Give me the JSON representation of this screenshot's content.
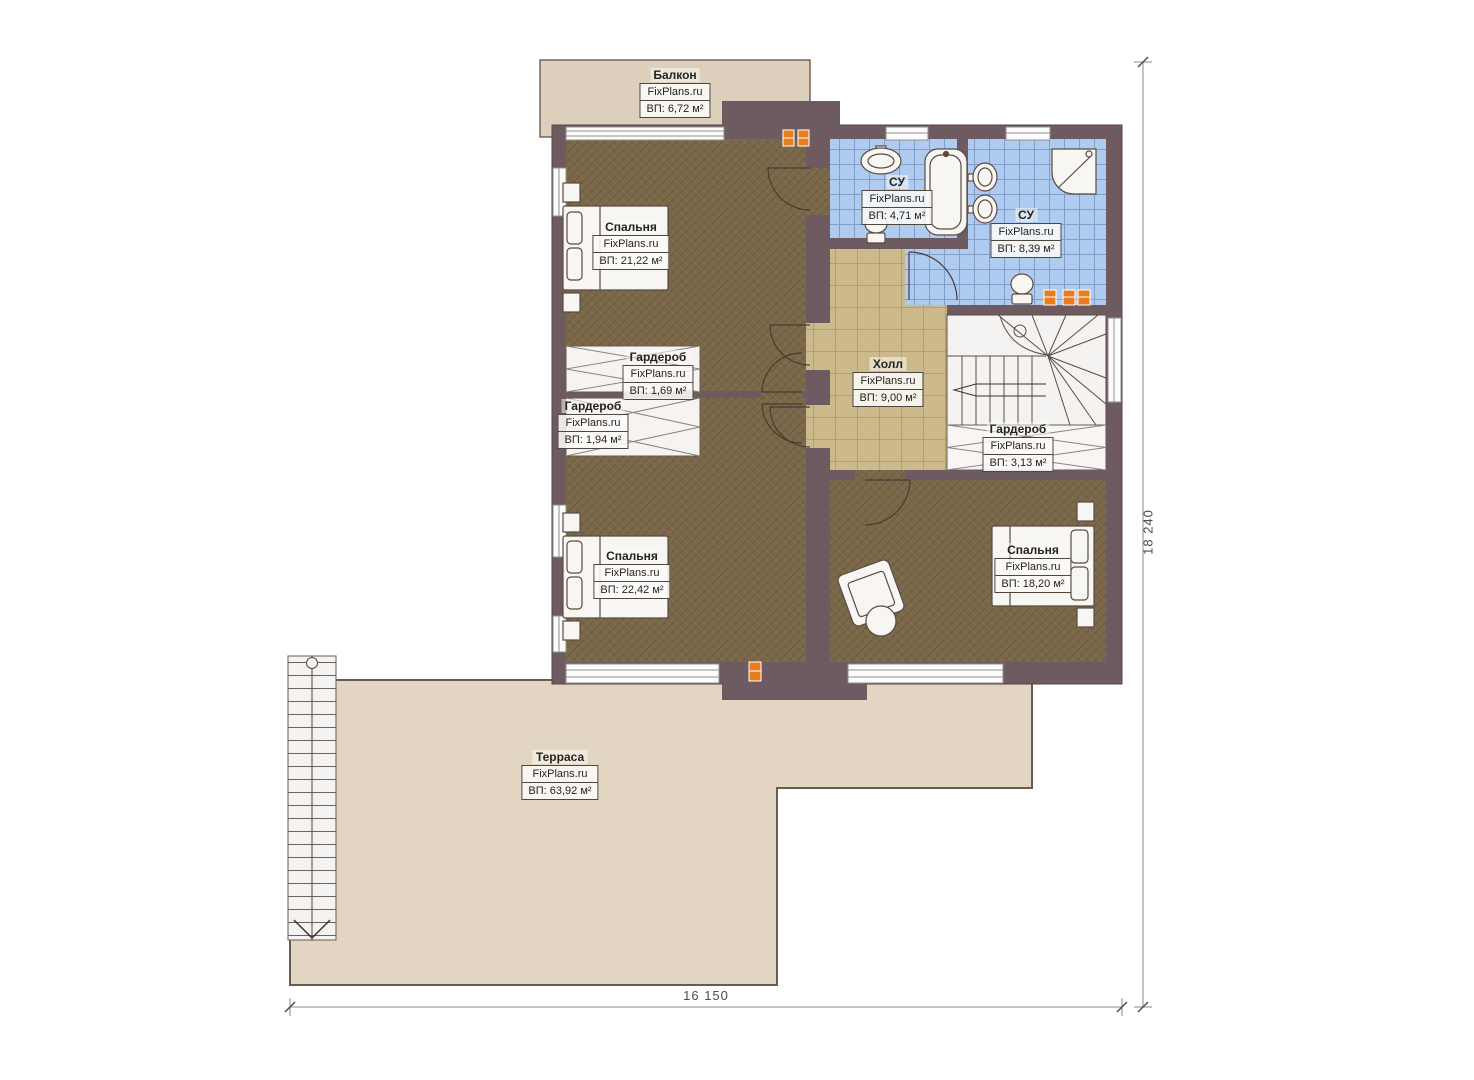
{
  "plan": {
    "brand": "FixPlans.ru",
    "rooms": [
      {
        "id": "balcony",
        "name": "Балкон",
        "brand": "FixPlans.ru",
        "area": "ВП: 6,72 м²"
      },
      {
        "id": "bedroom1",
        "name": "Спальня",
        "brand": "FixPlans.ru",
        "area": "ВП: 21,22 м²"
      },
      {
        "id": "bath1",
        "name": "СУ",
        "brand": "FixPlans.ru",
        "area": "ВП: 4,71 м²"
      },
      {
        "id": "bath2",
        "name": "СУ",
        "brand": "FixPlans.ru",
        "area": "ВП: 8,39 м²"
      },
      {
        "id": "hall",
        "name": "Холл",
        "brand": "FixPlans.ru",
        "area": "ВП: 9,00 м²"
      },
      {
        "id": "wardrobe1",
        "name": "Гардероб",
        "brand": "FixPlans.ru",
        "area": "ВП: 1,69 м²"
      },
      {
        "id": "wardrobe2",
        "name": "Гардероб",
        "brand": "FixPlans.ru",
        "area": "ВП: 1,94 м²"
      },
      {
        "id": "wardrobe3",
        "name": "Гардероб",
        "brand": "FixPlans.ru",
        "area": "ВП: 3,13 м²"
      },
      {
        "id": "bedroom2",
        "name": "Спальня",
        "brand": "FixPlans.ru",
        "area": "ВП: 22,42 м²"
      },
      {
        "id": "bedroom3",
        "name": "Спальня",
        "brand": "FixPlans.ru",
        "area": "ВП: 18,20 м²"
      },
      {
        "id": "terrace",
        "name": "Терраса",
        "brand": "FixPlans.ru",
        "area": "ВП: 63,92 м²"
      }
    ],
    "dimensions": {
      "width_label": "16 150",
      "height_label": "18 240"
    },
    "colors": {
      "wall": "#6e5b61",
      "bedroom_floor": "#7b684a",
      "hall_floor": "#ccba8d",
      "bath_floor": "#afccf0",
      "terrace": "#e2d5c2",
      "balcony": "#dcd0bd",
      "stairs": "#f4f3f1",
      "radiator": "#e87d1e"
    }
  }
}
